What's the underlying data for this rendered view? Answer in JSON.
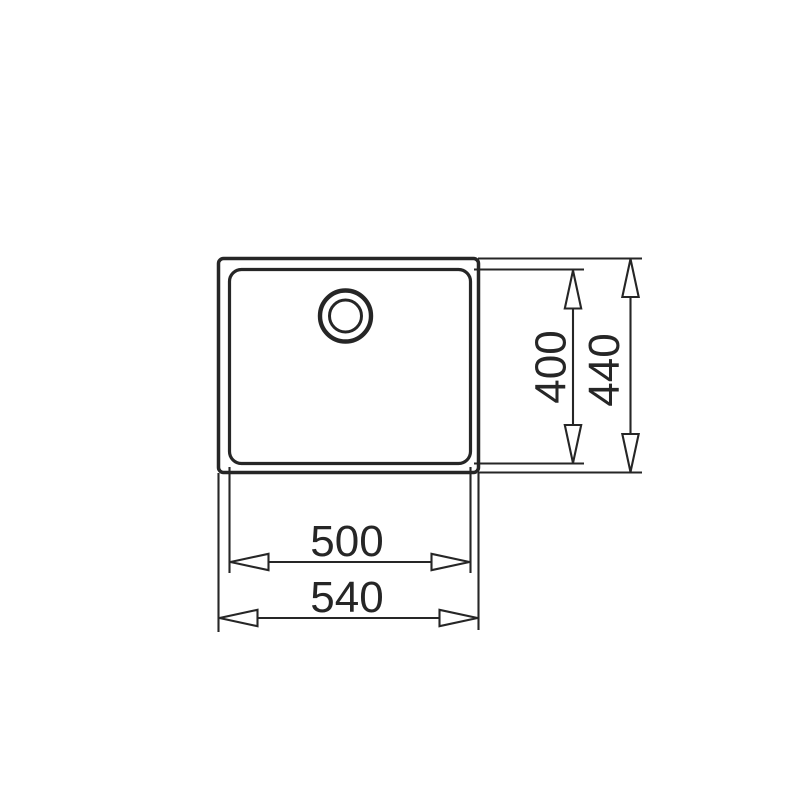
{
  "drawing": {
    "background_color": "#ffffff",
    "line_color": "#262626",
    "subject": "sink-top-view-dimension-drawing",
    "dimensions": [
      {
        "name": "bowl-depth",
        "label": "400",
        "orientation": "vertical"
      },
      {
        "name": "overall-depth",
        "label": "440",
        "orientation": "vertical"
      },
      {
        "name": "bowl-width",
        "label": "500",
        "orientation": "horizontal"
      },
      {
        "name": "overall-width",
        "label": "540",
        "orientation": "horizontal"
      }
    ]
  }
}
